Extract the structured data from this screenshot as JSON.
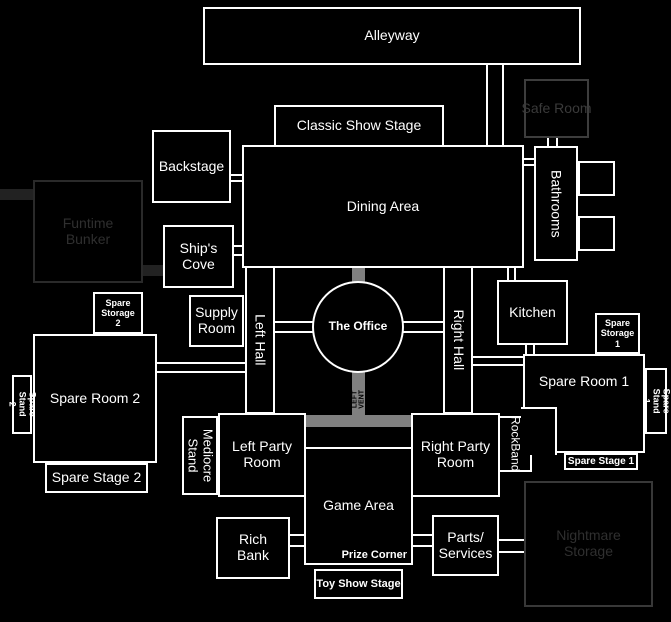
{
  "map": {
    "background_color": "#000000",
    "wall_color": "#ffffff",
    "vent_color": "#808080",
    "vent_text_color": "#000000",
    "hidden_rooms": {
      "funtime_bunker": {
        "border": "#2a2a2a",
        "text": "#2f2f2f"
      },
      "safe_room": {
        "border": "#3d3d3d",
        "text": "#3a3a3a"
      },
      "nightmare_storage": {
        "border": "#383838",
        "text": "#2f2f2f"
      }
    },
    "rooms": {
      "alleyway": "Alleyway",
      "classic_show_stage": "Classic Show Stage",
      "safe_room": "Safe Room",
      "backstage": "Backstage",
      "dining_area": "Dining Area",
      "bathrooms": "Bathrooms",
      "funtime_bunker": "Funtime Bunker",
      "ships_cove": "Ship's Cove",
      "supply_room": "Supply Room",
      "left_hall": "Left Hall",
      "the_office": "The Office",
      "right_hall": "Right Hall",
      "kitchen": "Kitchen",
      "spare_storage_2": "Spare Storage 2",
      "spare_room_2": "Spare Room 2",
      "spare_stand_2": "Spare Stand 2",
      "spare_stage_2": "Spare Stage 2",
      "spare_storage_1": "Spare Storage 1",
      "spare_room_1": "Spare Room 1",
      "spare_stand_1": "Spare Stand 1",
      "spare_stage_1": "Spare Stage 1",
      "mediocre_stand": "Mediocre Stand",
      "left_party_room": "Left Party Room",
      "right_party_room": "Right Party Room",
      "rockband": "RockBand",
      "game_area": "Game Area",
      "prize_corner": "Prize Corner",
      "toy_show_stage": "Toy Show Stage",
      "rich_bank": "Rich Bank",
      "parts_services": "Parts/ Services",
      "nightmare_storage": "Nightmare Storage"
    },
    "labels": {
      "left_vent": "LEFT VENT"
    }
  }
}
